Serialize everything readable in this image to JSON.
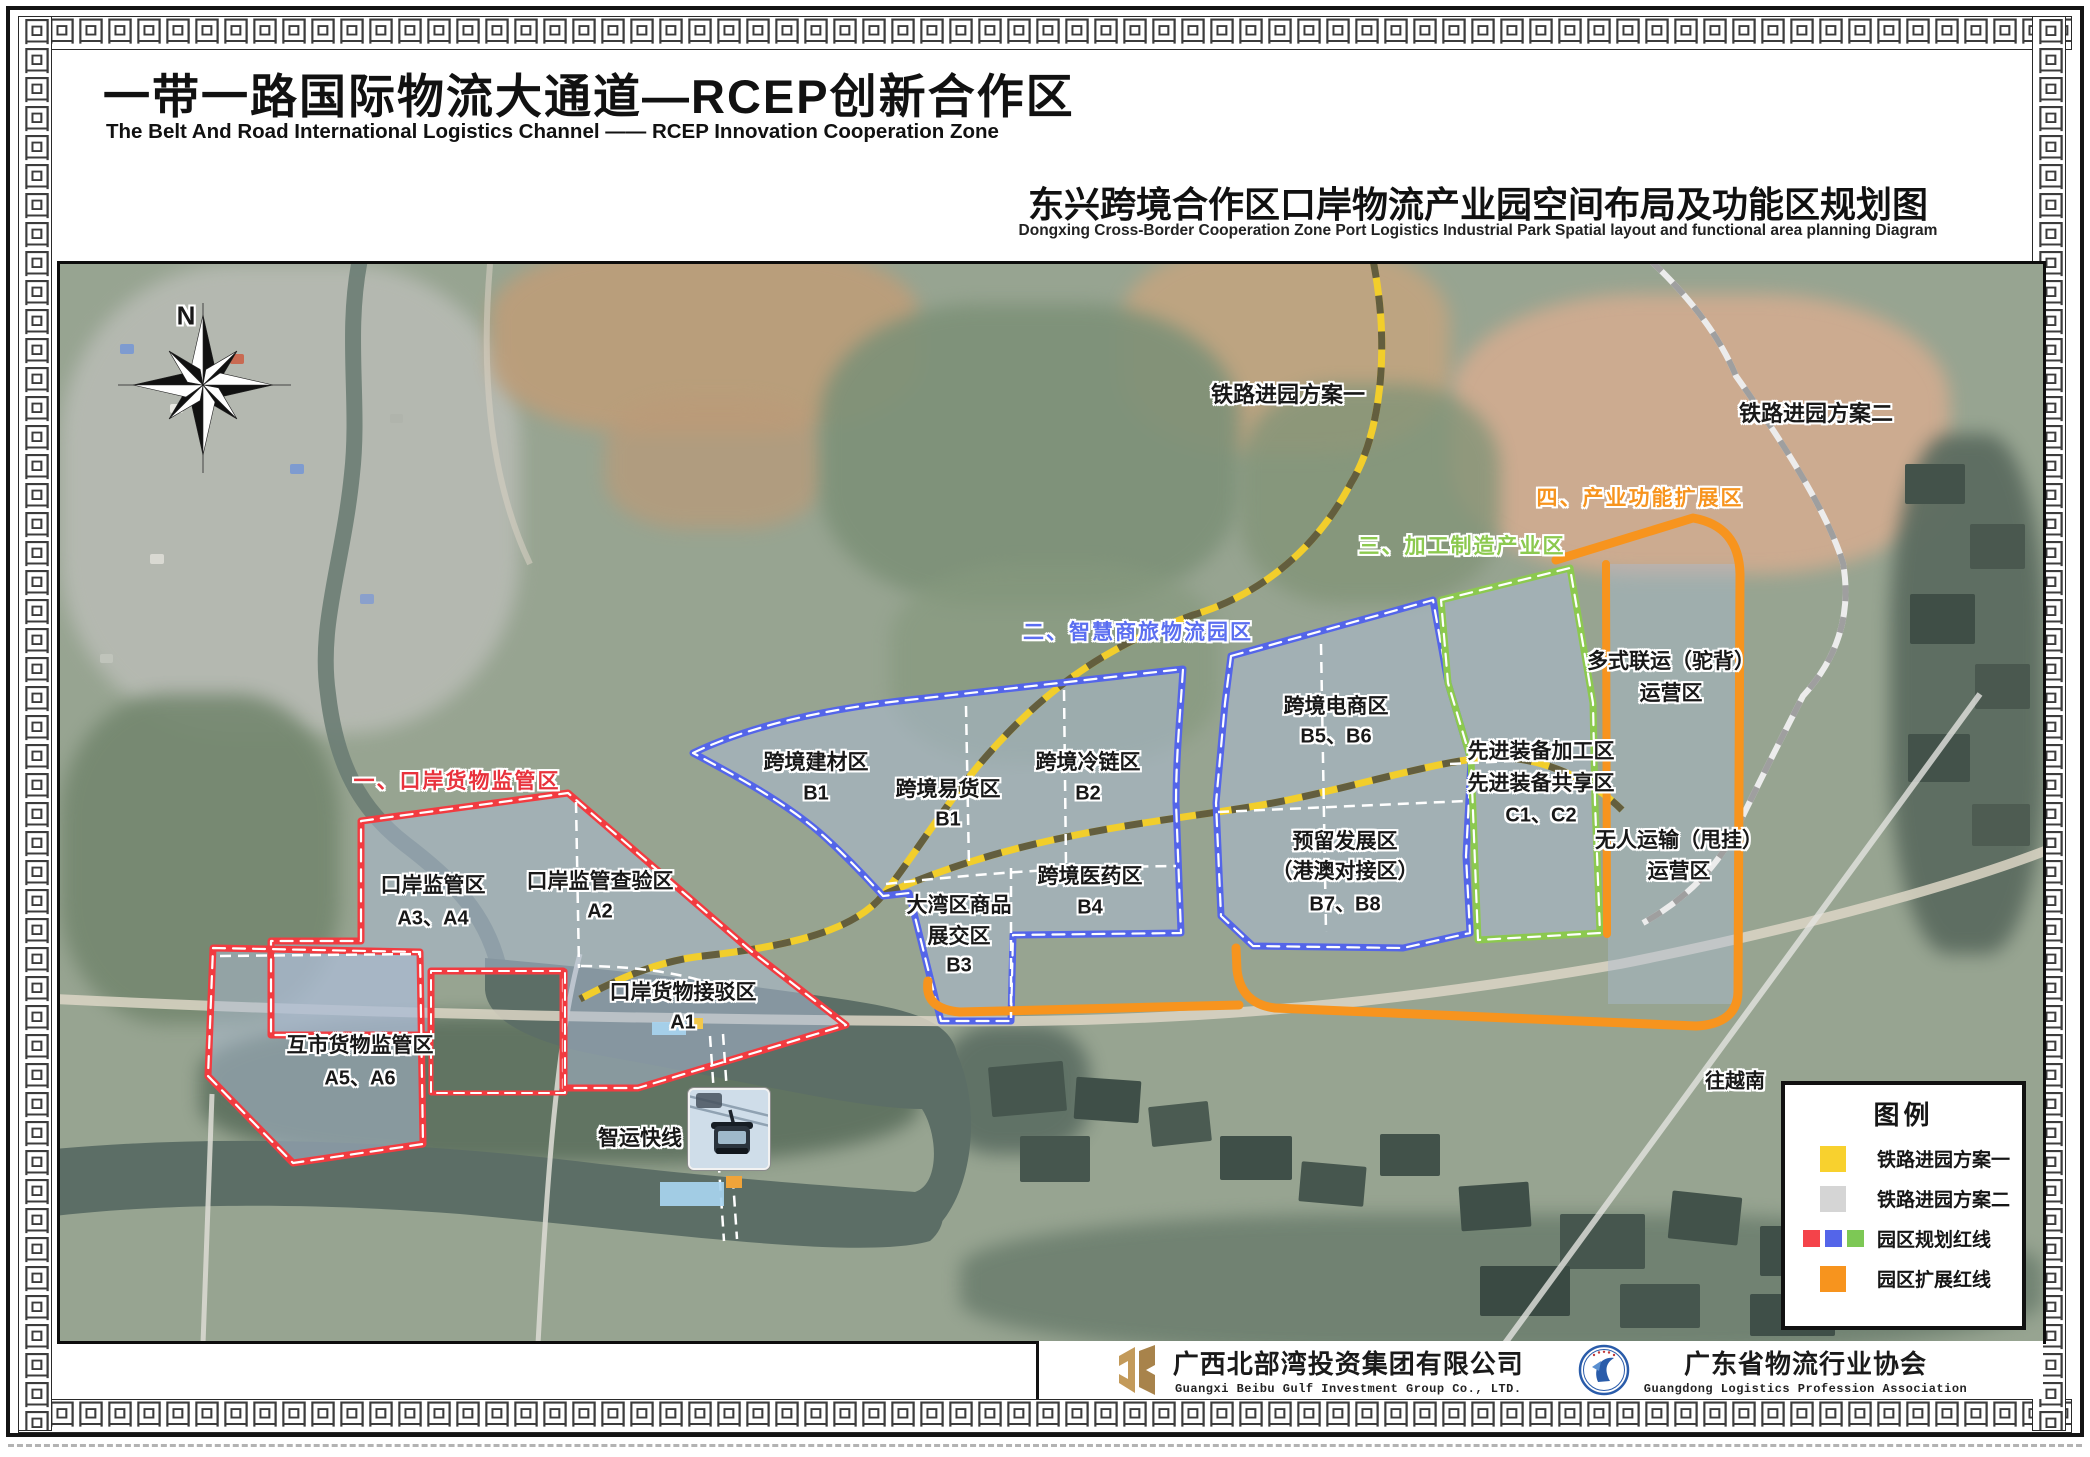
{
  "page": {
    "border_pattern_char": "回"
  },
  "titles": {
    "main_cn": "一带一路国际物流大通道—RCEP创新合作区",
    "main_en": "The Belt And Road International Logistics Channel —— RCEP Innovation Cooperation Zone",
    "sub_cn": "东兴跨境合作区口岸物流产业园空间布局及功能区规划图",
    "sub_en": "Dongxing Cross-Border Cooperation Zone Port Logistics Industrial Park Spatial layout and functional area planning Diagram"
  },
  "compass": {
    "north": "N"
  },
  "map": {
    "zone_titles": {
      "red": "一、口岸货物监管区",
      "blue": "二、智慧商旅物流园区",
      "green": "三、加工制造产业区",
      "orange": "四、产业功能扩展区"
    },
    "railway_labels": {
      "plan1": "铁路进园方案一",
      "plan2": "铁路进园方案二"
    },
    "areas": {
      "a34": {
        "lines": [
          "口岸监管区",
          "A3、A4"
        ]
      },
      "a2": {
        "lines": [
          "口岸监管查验区",
          "A2"
        ]
      },
      "a1": {
        "lines": [
          "口岸货物接驳区",
          "A1"
        ]
      },
      "a56": {
        "lines": [
          "互市货物监管区",
          "A5、A6"
        ]
      },
      "b1_building": {
        "lines": [
          "跨境建材区",
          "B1"
        ]
      },
      "b1_barter": {
        "lines": [
          "跨境易货区",
          "B1"
        ]
      },
      "b2_cold": {
        "lines": [
          "跨境冷链区",
          "B2"
        ]
      },
      "b3_expo": {
        "lines": [
          "大湾区商品",
          "展交区",
          "B3"
        ]
      },
      "b4_medicine": {
        "lines": [
          "跨境医药区",
          "B4"
        ]
      },
      "b56_ecommerce": {
        "lines": [
          "跨境电商区",
          "B5、B6"
        ]
      },
      "b78_reserved": {
        "lines": [
          "预留发展区",
          "（港澳对接区）",
          "B7、B8"
        ]
      },
      "c12_equipment": {
        "lines": [
          "先进装备加工区",
          "先进装备共享区",
          "C1、C2"
        ]
      },
      "multimodal": {
        "lines": [
          "多式联运（驼背）",
          "运营区"
        ]
      },
      "unmanned": {
        "lines": [
          "无人运输（甩挂）",
          "运营区"
        ]
      }
    },
    "misc": {
      "cable_line": "智运快线",
      "to_vietnam": "往越南"
    }
  },
  "legend": {
    "title": "图例",
    "items": [
      {
        "label": "铁路进园方案一"
      },
      {
        "label": "铁路进园方案二"
      },
      {
        "label": "园区规划红线"
      },
      {
        "label": "园区扩展红线"
      }
    ]
  },
  "footer": {
    "company1_cn": "广西北部湾投资集团有限公司",
    "company1_en": "Guangxi Beibu Gulf Investment Group Co., LTD.",
    "company2_cn": "广东省物流行业协会",
    "company2_en": "Guangdong Logistics Profession Association"
  },
  "colors": {
    "planning_red": "#F23B40",
    "planning_blue": "#5465E9",
    "planning_green": "#8CC94F",
    "expansion_orange": "#F7941E",
    "railway_plan1_yellow": "#F8D12E",
    "railway_plan2_gray": "#D5D5D5",
    "legend_trio": [
      "#F4434A",
      "#5465E9",
      "#7DC855"
    ],
    "gold_logo": "#C39A5A",
    "assoc_logo_blue": "#2A5CAA"
  }
}
